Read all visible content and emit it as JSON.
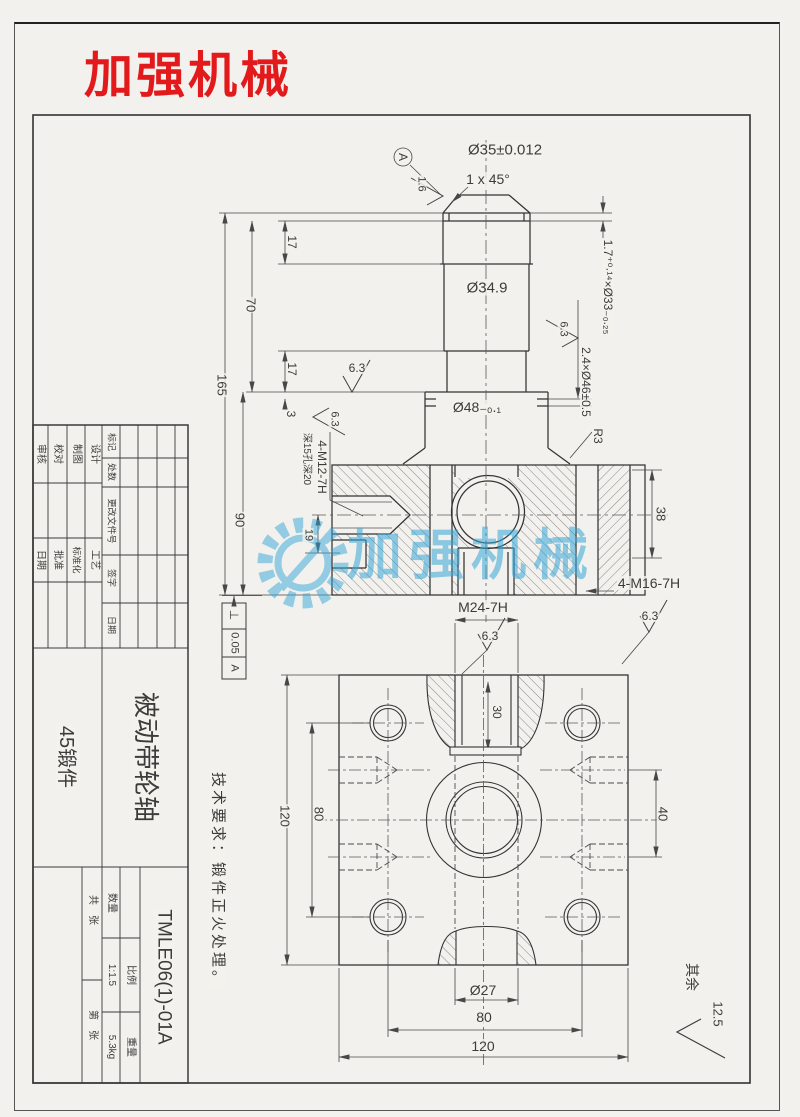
{
  "logo": "加强机械",
  "watermark": "加强机械",
  "colors": {
    "logo_red": "#e31a1c",
    "watermark_blue": "#35a6d9",
    "line": "#3a3a3a",
    "paper": "#f3f1ed"
  },
  "part": {
    "name": "被动带轮轴",
    "material": "45锻件",
    "number": "TMLE06(1)-01A",
    "scale": "1:1.5",
    "weight": "5.3kg",
    "tech_requirement": "技术要求：锻件正火处理。",
    "rest_roughness_label": "其余",
    "rest_roughness_value": "12.5"
  },
  "annotations": [
    {
      "n": "dim-dia35",
      "t": "Ø35±0.012",
      "x": 505,
      "y": 150,
      "r": 0,
      "s": 15
    },
    {
      "n": "dim-chamfer",
      "t": "1 x 45°",
      "x": 488,
      "y": 179,
      "r": 0,
      "s": 14
    },
    {
      "n": "datum-a-label",
      "t": "A",
      "x": 403,
      "y": 157,
      "r": 90,
      "s": 12
    },
    {
      "n": "rough-1-6",
      "t": "1.6",
      "x": 421,
      "y": 184,
      "r": 90,
      "s": 11
    },
    {
      "n": "dim-groove-top",
      "t": "1.7⁺⁰·¹⁴×Ø33₋₀.₂₅",
      "x": 608,
      "y": 287,
      "r": 90,
      "s": 12
    },
    {
      "n": "dim-groove-flange",
      "t": "2.4×Ø46±0.5",
      "x": 586,
      "y": 382,
      "r": 90,
      "s": 12
    },
    {
      "n": "rough-6-3-groove",
      "t": "6.3",
      "x": 563,
      "y": 329,
      "r": 90,
      "s": 11
    },
    {
      "n": "dim-dia34-9",
      "t": "Ø34.9",
      "x": 487,
      "y": 288,
      "r": 0,
      "s": 15
    },
    {
      "n": "rough-6-3-left",
      "t": "6.3",
      "x": 357,
      "y": 368,
      "r": 0,
      "s": 12
    },
    {
      "n": "dim-17-top",
      "t": "17",
      "x": 292,
      "y": 242,
      "r": 90,
      "s": 12
    },
    {
      "n": "dim-70",
      "t": "70",
      "x": 251,
      "y": 305,
      "r": 90,
      "s": 13
    },
    {
      "n": "dim-165",
      "t": "165",
      "x": 222,
      "y": 385,
      "r": 90,
      "s": 13
    },
    {
      "n": "dim-17-mid",
      "t": "17",
      "x": 292,
      "y": 369,
      "r": 90,
      "s": 12
    },
    {
      "n": "dim-3",
      "t": "3",
      "x": 291,
      "y": 414,
      "r": 90,
      "s": 12
    },
    {
      "n": "dim-90",
      "t": "90",
      "x": 240,
      "y": 520,
      "r": 90,
      "s": 13
    },
    {
      "n": "thread-m12",
      "t": "4-M12-7H",
      "x": 322,
      "y": 467,
      "r": 90,
      "s": 12
    },
    {
      "n": "thread-m12-depth",
      "t": "深15孔深20",
      "x": 306,
      "y": 459,
      "r": 90,
      "s": 10
    },
    {
      "n": "rough-6-3-m12",
      "t": "6.3",
      "x": 334,
      "y": 419,
      "r": 90,
      "s": 11
    },
    {
      "n": "dim-dia48",
      "t": "Ø48₋₀.₁",
      "x": 477,
      "y": 407,
      "r": 0,
      "s": 14
    },
    {
      "n": "dim-r3",
      "t": "R3",
      "x": 598,
      "y": 436,
      "r": 90,
      "s": 12
    },
    {
      "n": "dim-38",
      "t": "38",
      "x": 661,
      "y": 514,
      "r": 90,
      "s": 13
    },
    {
      "n": "dim-19",
      "t": "19",
      "x": 308,
      "y": 535,
      "r": 90,
      "s": 11
    },
    {
      "n": "thread-m16",
      "t": "4-M16-7H",
      "x": 649,
      "y": 583,
      "r": 0,
      "s": 14
    },
    {
      "n": "rough-6-3-m16",
      "t": "6.3",
      "x": 650,
      "y": 616,
      "r": 0,
      "s": 12
    },
    {
      "n": "thread-m24",
      "t": "M24-7H",
      "x": 483,
      "y": 607,
      "r": 0,
      "s": 14
    },
    {
      "n": "rough-6-3-m24",
      "t": "6.3",
      "x": 490,
      "y": 636,
      "r": 0,
      "s": 12
    },
    {
      "n": "tol-perp-symbol",
      "t": "⊥",
      "x": 234,
      "y": 615,
      "r": 90,
      "s": 12
    },
    {
      "n": "tol-perp-value",
      "t": "0.05",
      "x": 234,
      "y": 643,
      "r": 90,
      "s": 11
    },
    {
      "n": "tol-perp-datum",
      "t": "A",
      "x": 234,
      "y": 668,
      "r": 90,
      "s": 11
    },
    {
      "n": "dim-30",
      "t": "30",
      "x": 497,
      "y": 712,
      "r": 90,
      "s": 12
    },
    {
      "n": "dim-120-left",
      "t": "120",
      "x": 285,
      "y": 816,
      "r": 90,
      "s": 13
    },
    {
      "n": "dim-80-left",
      "t": "80",
      "x": 319,
      "y": 814,
      "r": 90,
      "s": 13
    },
    {
      "n": "dim-40",
      "t": "40",
      "x": 663,
      "y": 814,
      "r": 90,
      "s": 13
    },
    {
      "n": "dim-dia27",
      "t": "Ø27",
      "x": 483,
      "y": 990,
      "r": 0,
      "s": 14
    },
    {
      "n": "dim-80-bottom",
      "t": "80",
      "x": 484,
      "y": 1017,
      "r": 0,
      "s": 14
    },
    {
      "n": "dim-120-bottom",
      "t": "120",
      "x": 483,
      "y": 1046,
      "r": 0,
      "s": 14
    },
    {
      "n": "rest-rough-label",
      "t": "其余",
      "x": 692,
      "y": 977,
      "r": 90,
      "s": 14
    },
    {
      "n": "rest-rough-value",
      "t": "12.5",
      "x": 718,
      "y": 1014,
      "r": 90,
      "s": 13
    },
    {
      "n": "tech-requirement",
      "t": "技术要求：锻件正火处理。",
      "x": 218,
      "y": 880,
      "r": 90,
      "s": 15,
      "ls": 3
    },
    {
      "n": "tb-label-shenhe",
      "t": "审核",
      "x": 40,
      "y": 454,
      "r": 90,
      "s": 10
    },
    {
      "n": "tb-label-jiaodui",
      "t": "校对",
      "x": 57,
      "y": 454,
      "r": 90,
      "s": 10
    },
    {
      "n": "tb-label-zhitu",
      "t": "制图",
      "x": 76,
      "y": 454,
      "r": 90,
      "s": 10
    },
    {
      "n": "tb-label-sheji",
      "t": "设计",
      "x": 94,
      "y": 454,
      "r": 90,
      "s": 10
    },
    {
      "n": "tb-label-riqi",
      "t": "日期",
      "x": 40,
      "y": 560,
      "r": 90,
      "s": 10
    },
    {
      "n": "tb-label-pizhun",
      "t": "批准",
      "x": 57,
      "y": 560,
      "r": 90,
      "s": 10
    },
    {
      "n": "tb-label-biaozhunhua",
      "t": "标准化",
      "x": 76,
      "y": 560,
      "r": 90,
      "s": 9
    },
    {
      "n": "tb-label-gongyi",
      "t": "工艺",
      "x": 94,
      "y": 560,
      "r": 90,
      "s": 10
    },
    {
      "n": "tb-label-biaoji",
      "t": "标记",
      "x": 111,
      "y": 442,
      "r": 90,
      "s": 9
    },
    {
      "n": "tb-label-chushu",
      "t": "处数",
      "x": 111,
      "y": 472,
      "r": 90,
      "s": 9
    },
    {
      "n": "tb-label-genggai",
      "t": "更改文件号",
      "x": 111,
      "y": 521,
      "r": 90,
      "s": 9
    },
    {
      "n": "tb-label-qianzi",
      "t": "签字",
      "x": 111,
      "y": 578,
      "r": 90,
      "s": 9
    },
    {
      "n": "tb-label-riqi2",
      "t": "日期",
      "x": 111,
      "y": 625,
      "r": 90,
      "s": 9
    },
    {
      "n": "tb-part-name",
      "t": "被动带轮轴",
      "x": 146,
      "y": 757,
      "r": 90,
      "s": 26
    },
    {
      "n": "tb-material",
      "t": "45锻件",
      "x": 66,
      "y": 757,
      "r": 90,
      "s": 20
    },
    {
      "n": "tb-part-number",
      "t": "TMLE06(1)-01A",
      "x": 164,
      "y": 977,
      "r": 90,
      "s": 19
    },
    {
      "n": "tb-label-shuliang",
      "t": "数量",
      "x": 111,
      "y": 903,
      "r": 90,
      "s": 10
    },
    {
      "n": "tb-label-bili",
      "t": "比例",
      "x": 130,
      "y": 975,
      "r": 90,
      "s": 10
    },
    {
      "n": "tb-value-bili",
      "t": "1:1.5",
      "x": 111,
      "y": 975,
      "r": 90,
      "s": 10
    },
    {
      "n": "tb-label-zhongliang",
      "t": "重量",
      "x": 130,
      "y": 1047,
      "r": 90,
      "s": 10
    },
    {
      "n": "tb-value-zhongliang",
      "t": "5.3kg",
      "x": 111,
      "y": 1047,
      "r": 90,
      "s": 10
    },
    {
      "n": "tb-label-gongzhang",
      "t": "共　张",
      "x": 92,
      "y": 910,
      "r": 90,
      "s": 10
    },
    {
      "n": "tb-label-dizhang",
      "t": "第　张",
      "x": 92,
      "y": 1025,
      "r": 90,
      "s": 10
    }
  ]
}
